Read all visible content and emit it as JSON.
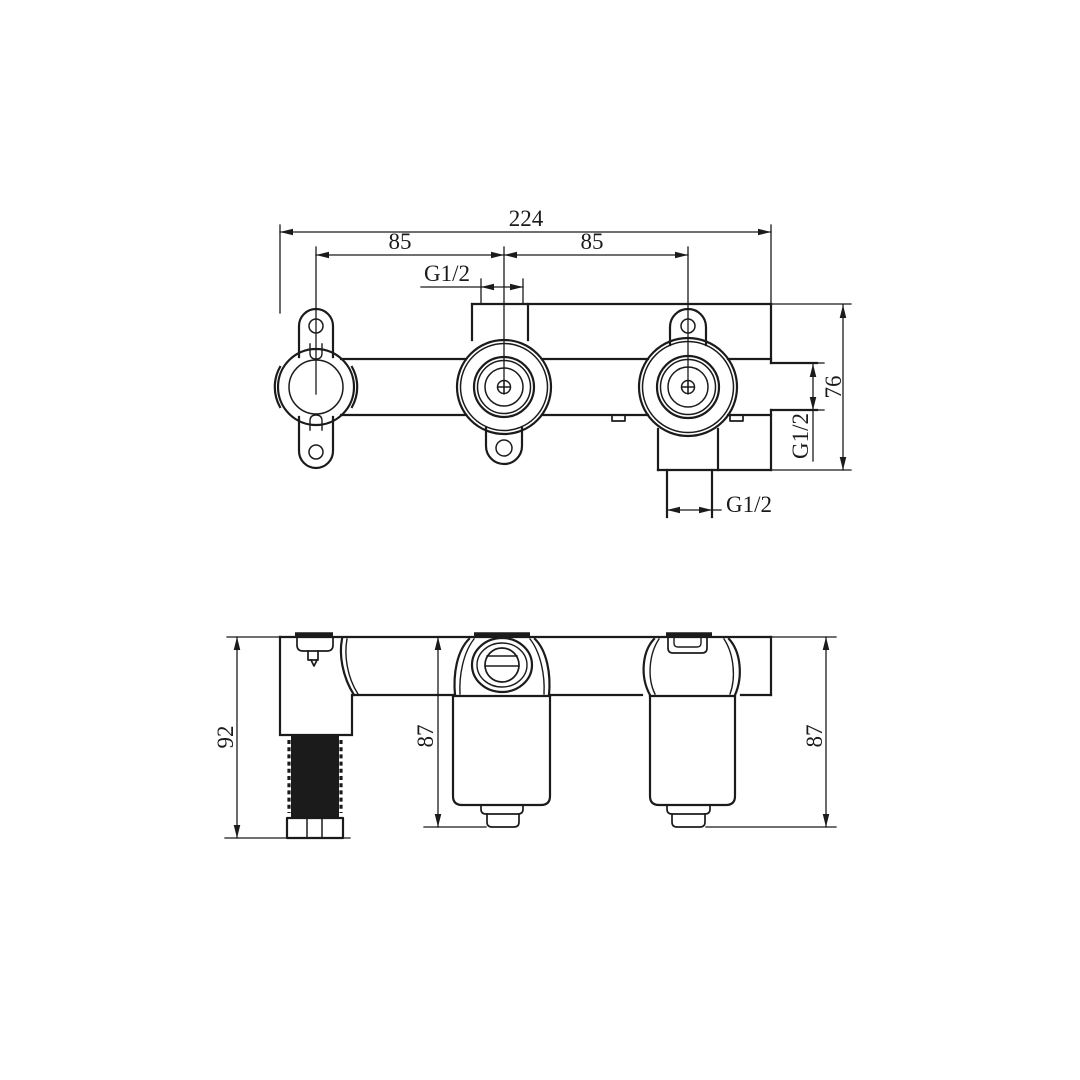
{
  "drawing": {
    "background": "#ffffff",
    "ink": "#1b1b1b",
    "front_view": {
      "dim_overall_width": "224",
      "dim_left_center_spacing": "85",
      "dim_right_center_spacing": "85",
      "dim_top_port_thread": "G1/2",
      "dim_body_height": "76",
      "dim_side_port_thread": "G1/2",
      "dim_bottom_port_thread": "G1/2"
    },
    "side_view": {
      "dim_left_body_depth": "92",
      "dim_center_body_depth": "87",
      "dim_right_body_depth": "87"
    }
  }
}
